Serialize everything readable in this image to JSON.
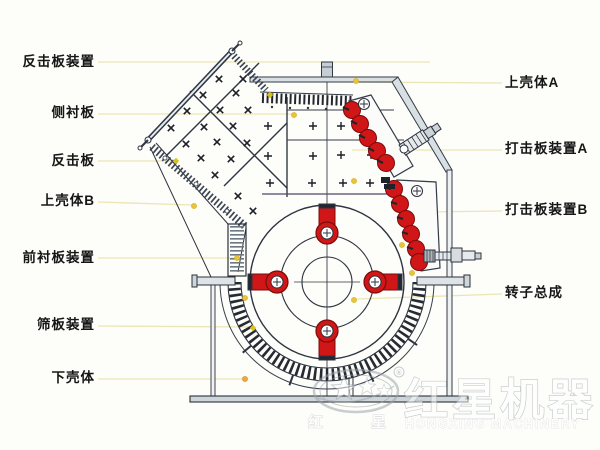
{
  "labels": {
    "left": [
      {
        "text": "反击板装置"
      },
      {
        "text": "侧衬板"
      },
      {
        "text": "反击板"
      },
      {
        "text": "上壳体B"
      },
      {
        "text": "前衬板装置"
      },
      {
        "text": "筛板装置"
      },
      {
        "text": "下壳体"
      }
    ],
    "right": [
      {
        "text": "上壳体A"
      },
      {
        "text": "打击板装置A"
      },
      {
        "text": "打击板装置B"
      },
      {
        "text": "转子总成"
      }
    ]
  },
  "watermark": {
    "registered": "®",
    "brand_cn": "红星机器",
    "brand_en": "HONGXING MACHINERY",
    "stamp_left": "红",
    "stamp_right": "星"
  },
  "colors": {
    "background": "#fdfdfa",
    "label_text": "#161616",
    "leader_line": "#ece5b4",
    "marker_yellow": "#e7c43a",
    "marker_orange": "#f0a73c",
    "machine_red": "#d01616",
    "machine_red_dark": "#7c0a0a",
    "line_dark": "#2e3440",
    "steel_fill": "#d8e0e4",
    "watermark_gray": "#9aa3ab"
  }
}
